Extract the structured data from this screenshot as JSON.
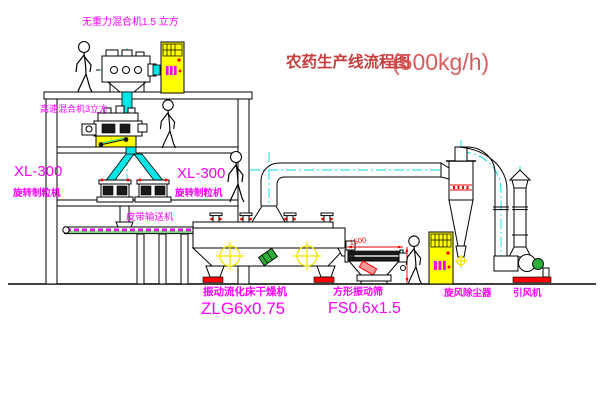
{
  "title": {
    "name": "农药生产线流程图",
    "capacity": "(500kg/h)"
  },
  "labels": {
    "gravity_free_mixer": "无重力混合机1.5 立方",
    "high_speed_mixer": "高速混合机3立方",
    "granulator_left_model": "XL-300",
    "granulator_left_name": "旋转制粒机",
    "granulator_mid_model": "XL-300",
    "granulator_mid_name": "旋转制粒机",
    "belt_conveyor": "皮带输送机",
    "fluid_bed_dryer_name": "振动流化床干燥机",
    "fluid_bed_dryer_model": "ZLG6x0.75",
    "square_sieve_name": "方形振动筛",
    "square_sieve_model": "FS0.6x1.5",
    "cyclone": "旋风除尘器",
    "induced_draft_fan": "引风机"
  },
  "dimensions": {
    "sieve_length": "1500"
  },
  "colors": {
    "label_magenta": "#ff00ff",
    "title_red": "#c83c3c",
    "centerline_cyan": "#00dcdc",
    "cabinet_yellow": "#ffff00",
    "accent_red": "#ff0000",
    "belt_green": "#00a000"
  }
}
